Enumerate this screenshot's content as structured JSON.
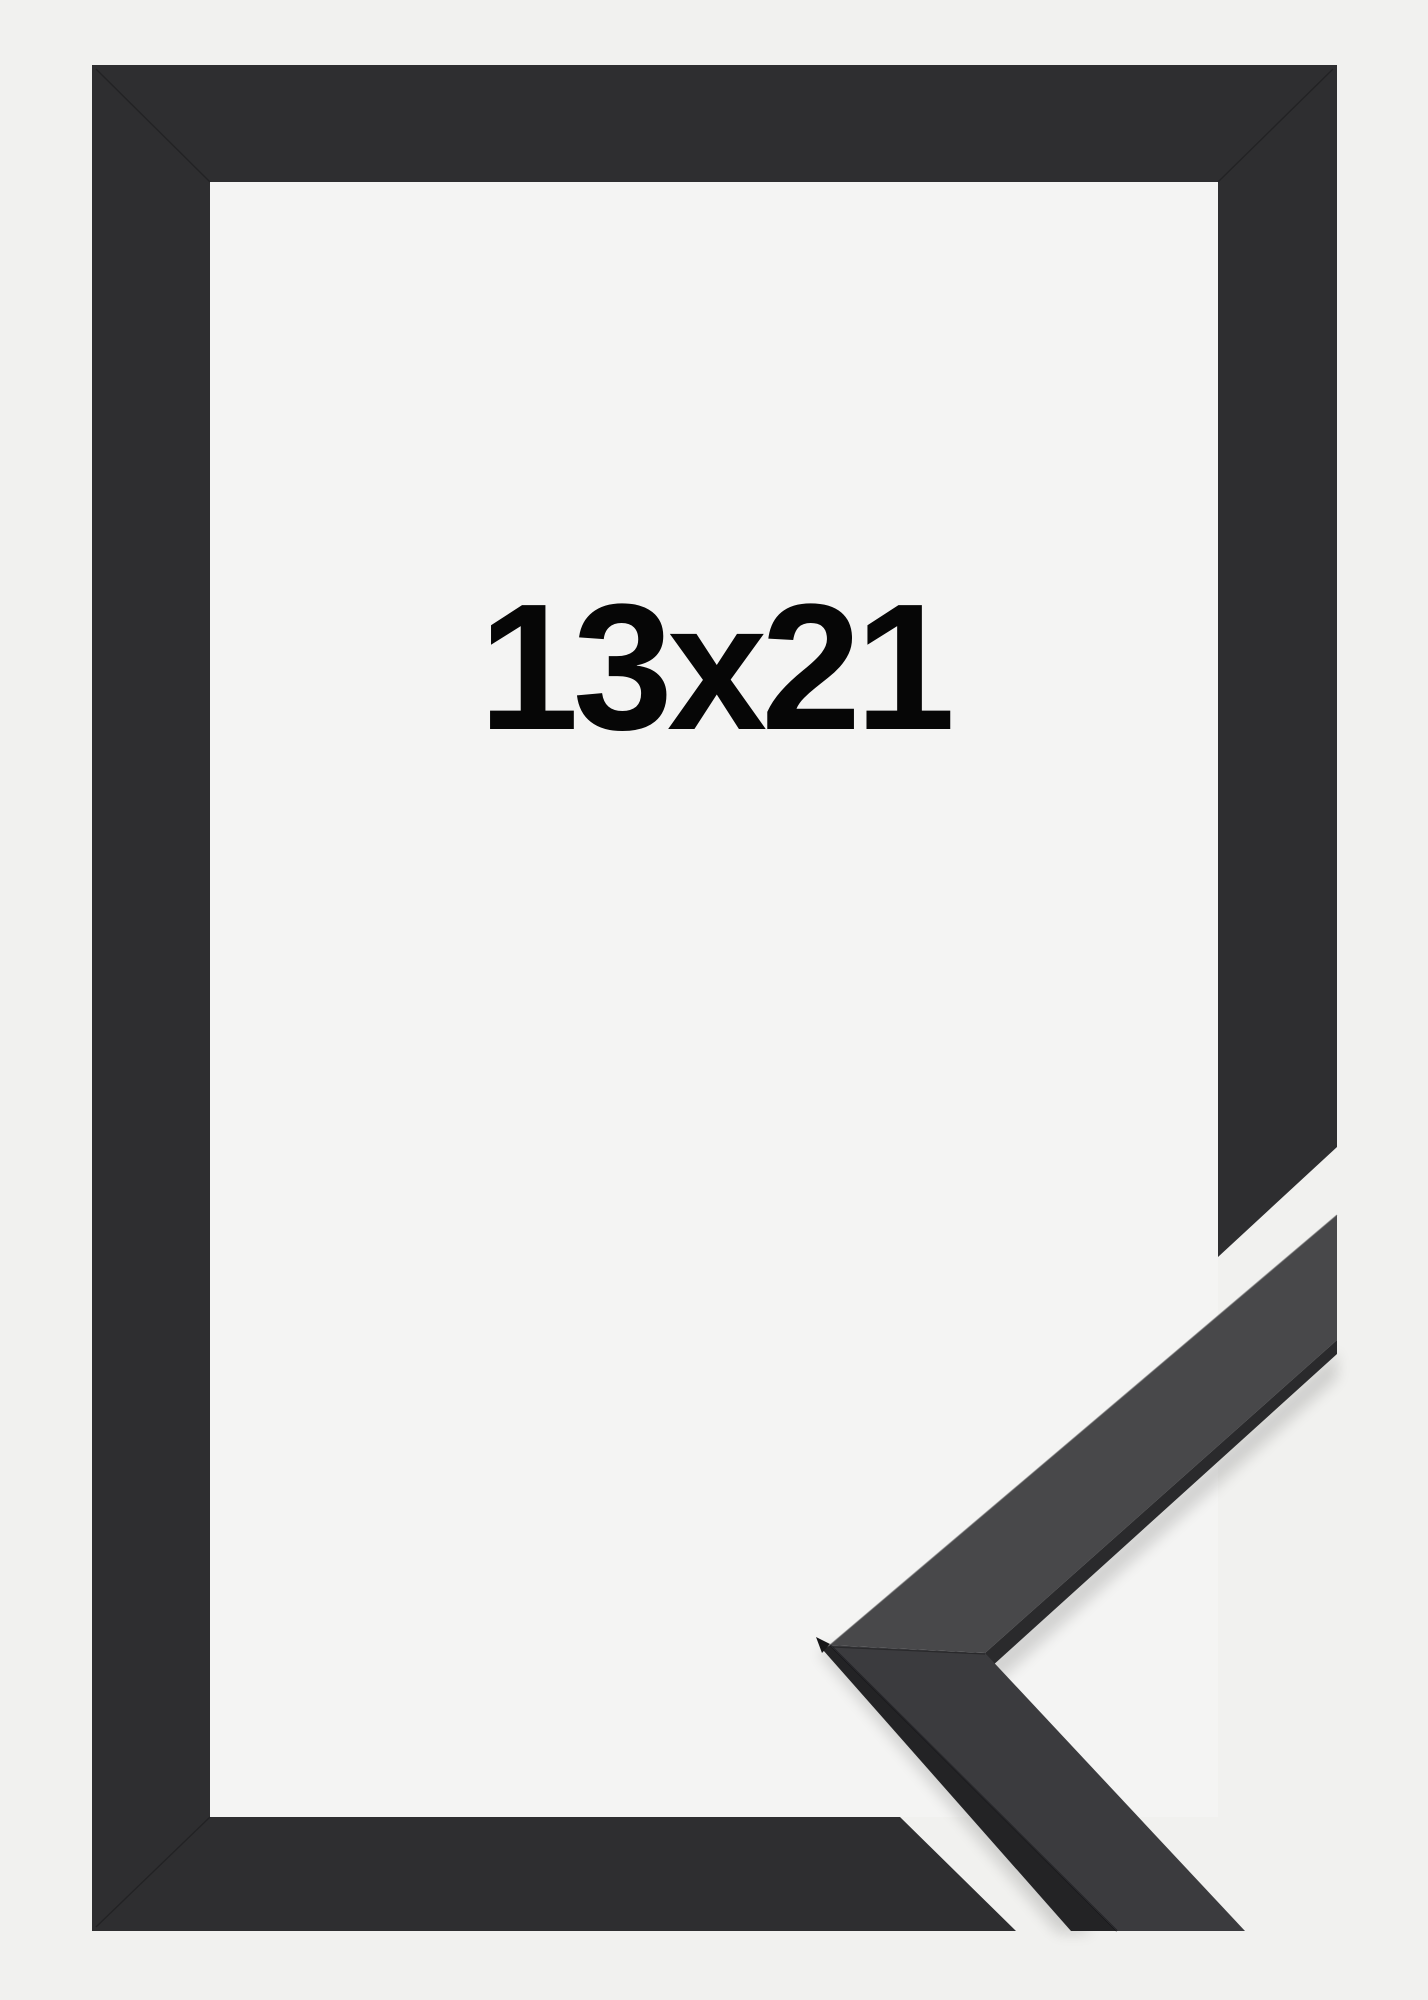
{
  "product": {
    "size_label": "13x21"
  },
  "colors": {
    "background": "#f1f1ef",
    "opening": "#f4f4f3",
    "frame": "#2e2e30",
    "sample_upper_face": "#48484a",
    "sample_lower_face": "#3b3b3e",
    "sample_side_dark": "#232325",
    "sample_edge_dark": "#2a2a2c",
    "sample_tip_facet": "#161618",
    "label_text": "#060606"
  }
}
